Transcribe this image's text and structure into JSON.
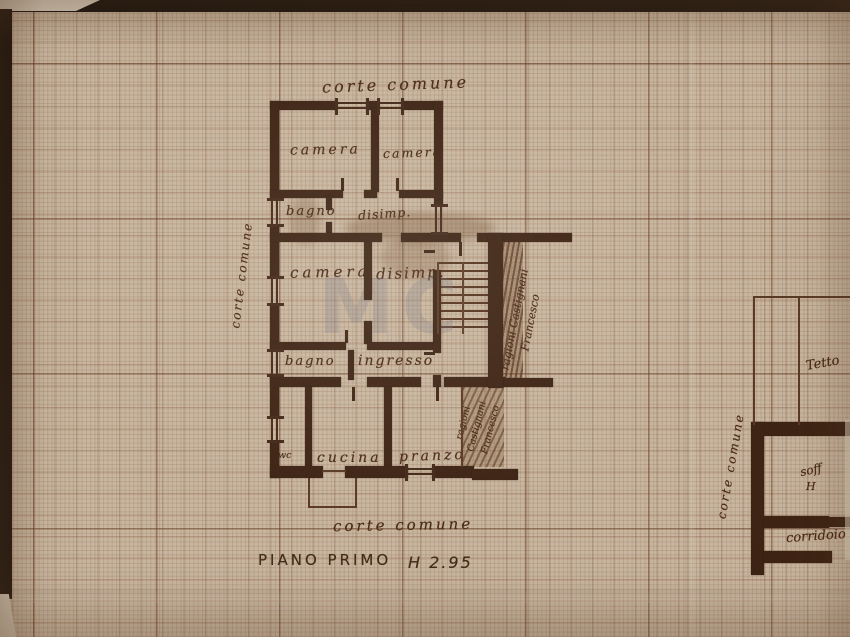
{
  "plan": {
    "floor_title": "PIANO PRIMO",
    "height_note": "H 2.95",
    "watermark": "MC",
    "courts": {
      "top": "corte comune",
      "bottom": "corte comune",
      "left": "corte comune",
      "right": "corte comune"
    },
    "rooms": {
      "camera_top_left": "camera",
      "camera_top_right": "camera",
      "bagno_top": "bagno",
      "disimp_top": "disimp.",
      "camera_mid": "camera",
      "disimp_mid": "disimp.",
      "bagno_lower": "bagno",
      "ingresso": "ingresso",
      "wc": "wc",
      "cucina": "cucina",
      "pranzo": "pranzo"
    },
    "boundary_notes": {
      "stair_strip_line1": "ragioni Castignani",
      "stair_strip_line2": "Francesco",
      "side_strip_line1": "ragioni",
      "side_strip_line2": "Castignani",
      "side_strip_line3": "Francesco"
    },
    "right_block": {
      "tetto": "Tetto",
      "soffitta": "soff",
      "soffitta_height": "H",
      "corridoio": "corridoio"
    }
  }
}
